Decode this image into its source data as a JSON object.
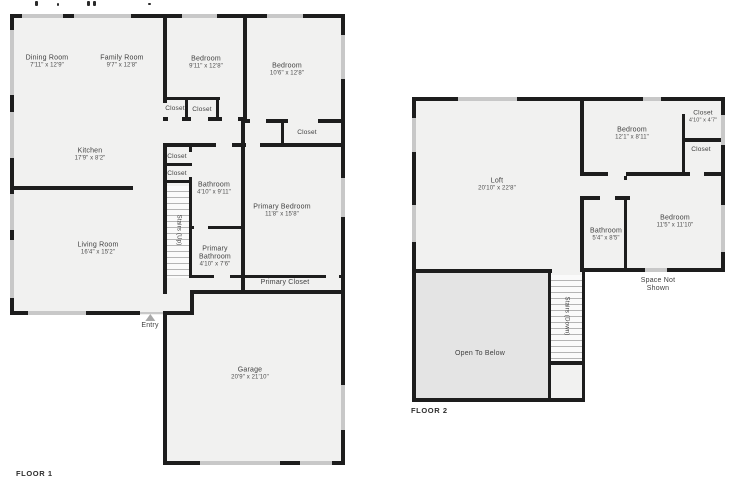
{
  "floor1": {
    "label": "FLOOR 1",
    "rooms": {
      "dining_room": {
        "name": "Dining Room",
        "dims": "7'11\" x 12'9\""
      },
      "family_room": {
        "name": "Family Room",
        "dims": "9'7\" x 12'8\""
      },
      "bedroom_left": {
        "name": "Bedroom",
        "dims": "9'11\" x 12'8\""
      },
      "bedroom_right": {
        "name": "Bedroom",
        "dims": "10'6\" x 12'8\""
      },
      "closet_hall_a": {
        "name": "Closet"
      },
      "closet_hall_b": {
        "name": "Closet"
      },
      "closet_bedroom_right": {
        "name": "Closet"
      },
      "kitchen": {
        "name": "Kitchen",
        "dims": "17'9\" x 8'2\""
      },
      "closet_stairs_a": {
        "name": "Closet"
      },
      "closet_stairs_b": {
        "name": "Closet"
      },
      "bathroom": {
        "name": "Bathroom",
        "dims": "4'10\" x 9'11\""
      },
      "stairs": {
        "name": "Stairs (Up)"
      },
      "primary_bedroom": {
        "name": "Primary Bedroom",
        "dims": "11'8\" x 15'8\""
      },
      "living_room": {
        "name": "Living Room",
        "dims": "16'4\" x 15'2\""
      },
      "primary_bathroom": {
        "name": "Primary Bathroom",
        "dims": "4'10\" x 7'6\""
      },
      "primary_closet": {
        "name": "Primary Closet"
      },
      "entry": {
        "name": "Entry"
      },
      "garage": {
        "name": "Garage",
        "dims": "20'9\" x 21'10\""
      }
    }
  },
  "floor2": {
    "label": "FLOOR 2",
    "rooms": {
      "loft": {
        "name": "Loft",
        "dims": "20'10\" x 22'8\""
      },
      "bedroom_top": {
        "name": "Bedroom",
        "dims": "12'1\" x 8'11\""
      },
      "closet_top": {
        "name": "Closet",
        "dims": "4'10\" x 4'7\""
      },
      "closet_side": {
        "name": "Closet"
      },
      "bathroom": {
        "name": "Bathroom",
        "dims": "5'4\" x 8'5\""
      },
      "bedroom_side": {
        "name": "Bedroom",
        "dims": "11'5\" x 11'10\""
      },
      "space_not_shown": {
        "name": "Space Not Shown"
      },
      "stairs": {
        "name": "Stairs (Down)"
      },
      "open_to_below": {
        "name": "Open To Below"
      }
    }
  },
  "colors": {
    "wall": "#1d1d1d",
    "room_fill": "#f1f1f0",
    "open_to_below_fill": "#e4e4e4",
    "window": "#c8c8c8",
    "label_text": "#3f3f3f"
  }
}
